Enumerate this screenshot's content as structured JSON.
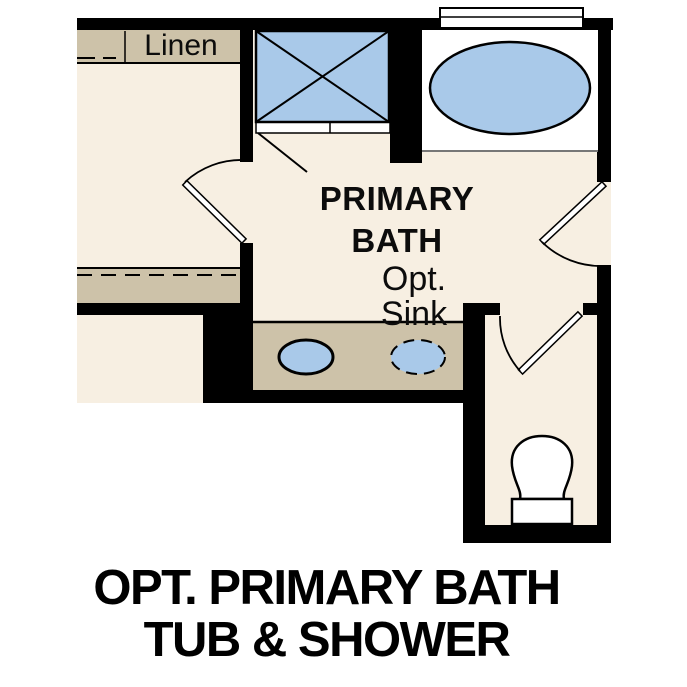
{
  "figure": {
    "room_label": {
      "line1": "PRIMARY",
      "line2": "BATH"
    },
    "linen_label": "Linen",
    "opt_sink": {
      "line1": "Opt.",
      "line2": "Sink"
    },
    "caption": {
      "line1": "OPT. PRIMARY BATH",
      "line2": "TUB & SHOWER"
    },
    "colors": {
      "floor": "#f7efe2",
      "casework": "#cdc2a9",
      "fixture_fill": "#a9c9e9",
      "wall": "#000000",
      "white": "#ffffff"
    },
    "fixture_icons": [
      "shower-icon",
      "bathtub-icon",
      "sink-icon",
      "optional-sink-icon",
      "toilet-icon",
      "window-icon",
      "door-swing-icon",
      "shelf-rod-icon"
    ]
  }
}
